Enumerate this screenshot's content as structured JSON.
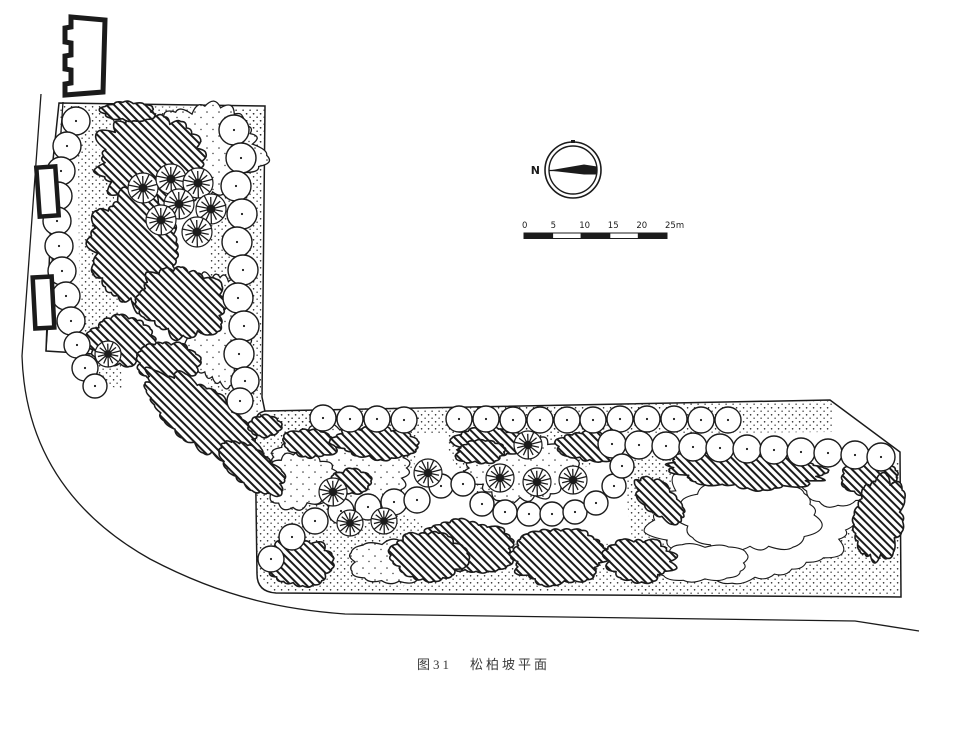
{
  "page": {
    "paper_color": "#ffffff",
    "ink_color": "#1b1b1b"
  },
  "caption": {
    "figure_no": "图31",
    "title": "松柏坡平面"
  },
  "compass": {
    "label": "N"
  },
  "scale_bar": {
    "tick_labels": [
      "0",
      "5",
      "10",
      "15",
      "20",
      "25m"
    ],
    "segments": 5,
    "unit": "m"
  },
  "plan": {
    "outlines": [
      {
        "name": "upper-block-outline",
        "d": "M59,103 L265,106 L262,397 L282,494 L142,357 L46,351 L53,160 Z"
      },
      {
        "name": "lower-strip-outline",
        "d": "M266,411 L830,400 L900,452 L901,597 L276,593 Q257,592 257,574 L255,428 Q254,412 266,411 Z"
      }
    ],
    "roads": [
      {
        "name": "road-curb-line",
        "d": "M41,94 L22,356 C25,448 70,514 150,559 C228,600 290,610 345,614 L855,621 L919,631"
      },
      {
        "name": "site-left-edge",
        "d": "M63,102 L46,351"
      }
    ],
    "stipple_areas": [
      {
        "pts": [
          [
            60,
            105
          ],
          [
            265,
            108
          ],
          [
            263,
            150
          ],
          [
            60,
            146
          ]
        ]
      },
      {
        "pts": [
          [
            78,
            148
          ],
          [
            112,
            150
          ],
          [
            122,
            392
          ],
          [
            80,
            368
          ]
        ]
      },
      {
        "pts": [
          [
            213,
            108
          ],
          [
            262,
            108
          ],
          [
            261,
            406
          ],
          [
            208,
            400
          ]
        ]
      },
      {
        "pts": [
          [
            146,
            356
          ],
          [
            282,
            482
          ],
          [
            282,
            496
          ],
          [
            138,
            362
          ]
        ]
      },
      {
        "pts": [
          [
            256,
            410
          ],
          [
            832,
            401
          ],
          [
            832,
            432
          ],
          [
            256,
            436
          ]
        ]
      },
      {
        "pts": [
          [
            257,
            470
          ],
          [
            330,
            470
          ],
          [
            425,
            525
          ],
          [
            428,
            562
          ],
          [
            398,
            592
          ],
          [
            270,
            592
          ],
          [
            256,
            570
          ]
        ]
      },
      {
        "pts": [
          [
            408,
            540
          ],
          [
            665,
            545
          ],
          [
            665,
            592
          ],
          [
            405,
            592
          ]
        ]
      },
      {
        "pts": [
          [
            618,
            438
          ],
          [
            900,
            458
          ],
          [
            901,
            596
          ],
          [
            640,
            596
          ]
        ]
      },
      {
        "pts": [
          [
            258,
            414
          ],
          [
            420,
            417
          ],
          [
            414,
            468
          ],
          [
            300,
            500
          ],
          [
            257,
            466
          ]
        ]
      },
      {
        "pts": [
          [
            450,
            417
          ],
          [
            597,
            420
          ],
          [
            590,
            466
          ],
          [
            470,
            496
          ],
          [
            447,
            448
          ]
        ]
      }
    ],
    "clouds": [
      {
        "cx": 205,
        "cy": 150,
        "rx": 55,
        "ry": 42,
        "rot": 5,
        "seed": 31
      },
      {
        "cx": 218,
        "cy": 330,
        "rx": 30,
        "ry": 55,
        "rot": 0,
        "seed": 32
      },
      {
        "cx": 340,
        "cy": 468,
        "rx": 62,
        "ry": 38,
        "rot": 0,
        "seed": 33
      },
      {
        "cx": 520,
        "cy": 468,
        "rx": 52,
        "ry": 32,
        "rot": 0,
        "seed": 34
      },
      {
        "cx": 297,
        "cy": 480,
        "rx": 36,
        "ry": 26,
        "rot": 0,
        "seed": 36
      },
      {
        "cx": 390,
        "cy": 562,
        "rx": 40,
        "ry": 20,
        "rot": 0,
        "seed": 37
      }
    ],
    "contours": [
      {
        "cx": 755,
        "cy": 520,
        "rx": 105,
        "ry": 58,
        "rot": 0,
        "seed": 41
      },
      {
        "cx": 750,
        "cy": 515,
        "rx": 66,
        "ry": 36,
        "rot": 0,
        "seed": 42
      },
      {
        "cx": 838,
        "cy": 478,
        "rx": 36,
        "ry": 26,
        "rot": 0,
        "seed": 43
      },
      {
        "cx": 700,
        "cy": 563,
        "rx": 46,
        "ry": 18,
        "rot": 0,
        "seed": 44
      }
    ],
    "shrubs": [
      {
        "cx": 152,
        "cy": 162,
        "rx": 55,
        "ry": 48,
        "rot": 15,
        "seed": 1
      },
      {
        "cx": 136,
        "cy": 248,
        "rx": 44,
        "ry": 58,
        "rot": -8,
        "seed": 2
      },
      {
        "cx": 182,
        "cy": 302,
        "rx": 42,
        "ry": 34,
        "rot": 20,
        "seed": 3
      },
      {
        "cx": 128,
        "cy": 111,
        "rx": 26,
        "ry": 9,
        "rot": 2,
        "seed": 4
      },
      {
        "cx": 122,
        "cy": 341,
        "rx": 34,
        "ry": 24,
        "rot": 0,
        "seed": 5
      },
      {
        "cx": 168,
        "cy": 362,
        "rx": 30,
        "ry": 20,
        "rot": 10,
        "seed": 6
      },
      {
        "cx": 205,
        "cy": 420,
        "rx": 72,
        "ry": 26,
        "rot": 38,
        "seed": 7
      },
      {
        "cx": 252,
        "cy": 468,
        "rx": 36,
        "ry": 18,
        "rot": 38,
        "seed": 8
      },
      {
        "cx": 310,
        "cy": 444,
        "rx": 26,
        "ry": 13,
        "rot": 8,
        "seed": 9
      },
      {
        "cx": 352,
        "cy": 481,
        "rx": 20,
        "ry": 11,
        "rot": 0,
        "seed": 10
      },
      {
        "cx": 375,
        "cy": 443,
        "rx": 40,
        "ry": 15,
        "rot": 3,
        "seed": 11
      },
      {
        "cx": 490,
        "cy": 442,
        "rx": 34,
        "ry": 14,
        "rot": 2,
        "seed": 12
      },
      {
        "cx": 588,
        "cy": 446,
        "rx": 30,
        "ry": 14,
        "rot": 4,
        "seed": 13
      },
      {
        "cx": 745,
        "cy": 470,
        "rx": 78,
        "ry": 17,
        "rot": 3,
        "seed": 14
      },
      {
        "cx": 870,
        "cy": 477,
        "rx": 26,
        "ry": 18,
        "rot": 0,
        "seed": 15
      },
      {
        "cx": 878,
        "cy": 518,
        "rx": 24,
        "ry": 42,
        "rot": 8,
        "seed": 16
      },
      {
        "cx": 470,
        "cy": 545,
        "rx": 45,
        "ry": 24,
        "rot": 5,
        "seed": 17
      },
      {
        "cx": 560,
        "cy": 556,
        "rx": 48,
        "ry": 26,
        "rot": -4,
        "seed": 18
      },
      {
        "cx": 640,
        "cy": 560,
        "rx": 34,
        "ry": 20,
        "rot": 3,
        "seed": 19
      },
      {
        "cx": 300,
        "cy": 562,
        "rx": 32,
        "ry": 22,
        "rot": 0,
        "seed": 20
      },
      {
        "cx": 428,
        "cy": 556,
        "rx": 36,
        "ry": 22,
        "rot": 6,
        "seed": 21
      },
      {
        "cx": 265,
        "cy": 426,
        "rx": 16,
        "ry": 9,
        "rot": 0,
        "seed": 22
      },
      {
        "cx": 480,
        "cy": 452,
        "rx": 24,
        "ry": 11,
        "rot": 0,
        "seed": 23
      },
      {
        "cx": 660,
        "cy": 500,
        "rx": 30,
        "ry": 14,
        "rot": 40,
        "seed": 24
      }
    ],
    "deciduous_trees": [
      [
        76,
        121,
        14
      ],
      [
        67,
        146,
        14
      ],
      [
        61,
        171,
        14
      ],
      [
        58,
        196,
        14
      ],
      [
        57,
        221,
        14
      ],
      [
        59,
        246,
        14
      ],
      [
        62,
        271,
        14
      ],
      [
        66,
        296,
        14
      ],
      [
        71,
        321,
        14
      ],
      [
        77,
        345,
        13
      ],
      [
        85,
        368,
        13
      ],
      [
        95,
        386,
        12
      ],
      [
        234,
        130,
        15
      ],
      [
        241,
        158,
        15
      ],
      [
        236,
        186,
        15
      ],
      [
        242,
        214,
        15
      ],
      [
        237,
        242,
        15
      ],
      [
        243,
        270,
        15
      ],
      [
        238,
        298,
        15
      ],
      [
        244,
        326,
        15
      ],
      [
        239,
        354,
        15
      ],
      [
        245,
        381,
        14
      ],
      [
        240,
        401,
        13
      ],
      [
        323,
        418,
        13
      ],
      [
        350,
        419,
        13
      ],
      [
        377,
        419,
        13
      ],
      [
        404,
        420,
        13
      ],
      [
        459,
        419,
        13
      ],
      [
        486,
        419,
        13
      ],
      [
        513,
        420,
        13
      ],
      [
        540,
        420,
        13
      ],
      [
        567,
        420,
        13
      ],
      [
        593,
        420,
        13
      ],
      [
        620,
        419,
        13
      ],
      [
        647,
        419,
        13
      ],
      [
        674,
        419,
        13
      ],
      [
        701,
        420,
        13
      ],
      [
        728,
        420,
        13
      ],
      [
        612,
        444,
        14
      ],
      [
        639,
        445,
        14
      ],
      [
        666,
        446,
        14
      ],
      [
        693,
        447,
        14
      ],
      [
        720,
        448,
        14
      ],
      [
        747,
        449,
        14
      ],
      [
        774,
        450,
        14
      ],
      [
        801,
        452,
        14
      ],
      [
        828,
        453,
        14
      ],
      [
        855,
        455,
        14
      ],
      [
        881,
        457,
        14
      ],
      [
        271,
        559,
        13
      ],
      [
        292,
        537,
        13
      ],
      [
        315,
        521,
        13
      ],
      [
        341,
        511,
        13
      ],
      [
        368,
        507,
        13
      ],
      [
        394,
        502,
        13
      ],
      [
        417,
        500,
        13
      ],
      [
        441,
        486,
        12
      ],
      [
        463,
        484,
        12
      ],
      [
        482,
        504,
        12
      ],
      [
        505,
        512,
        12
      ],
      [
        529,
        514,
        12
      ],
      [
        552,
        514,
        12
      ],
      [
        575,
        512,
        12
      ],
      [
        596,
        503,
        12
      ],
      [
        614,
        486,
        12
      ],
      [
        622,
        466,
        12
      ]
    ],
    "conifer_trees": [
      [
        143,
        188,
        15
      ],
      [
        171,
        179,
        15
      ],
      [
        198,
        183,
        15
      ],
      [
        179,
        204,
        15
      ],
      [
        211,
        209,
        15
      ],
      [
        161,
        220,
        15
      ],
      [
        197,
        232,
        15
      ],
      [
        108,
        354,
        13
      ],
      [
        333,
        492,
        14
      ],
      [
        350,
        523,
        13
      ],
      [
        384,
        521,
        13
      ],
      [
        428,
        473,
        14
      ],
      [
        500,
        478,
        14
      ],
      [
        537,
        482,
        14
      ],
      [
        573,
        480,
        14
      ],
      [
        528,
        445,
        14
      ]
    ],
    "buildings": [
      {
        "name": "building-footprint",
        "d": "M71,17 L105,20 L103,92 L65,95 L65,84 L71,83 L71,70 L65,69 L65,56 L71,55 L71,43 L65,42 L65,28 L71,27 Z"
      }
    ],
    "structures": [
      {
        "x": 38,
        "y": 167,
        "w": 19,
        "h": 49,
        "rot": -4
      },
      {
        "x": 34,
        "y": 277,
        "w": 19,
        "h": 51,
        "rot": -3
      }
    ],
    "compass_geo": {
      "cx": 573,
      "cy": 170,
      "r_outer": 28,
      "r_inner": 24
    },
    "scale_geo": {
      "x": 524,
      "y": 233,
      "seg_w": 28.6,
      "h": 5.5
    }
  }
}
